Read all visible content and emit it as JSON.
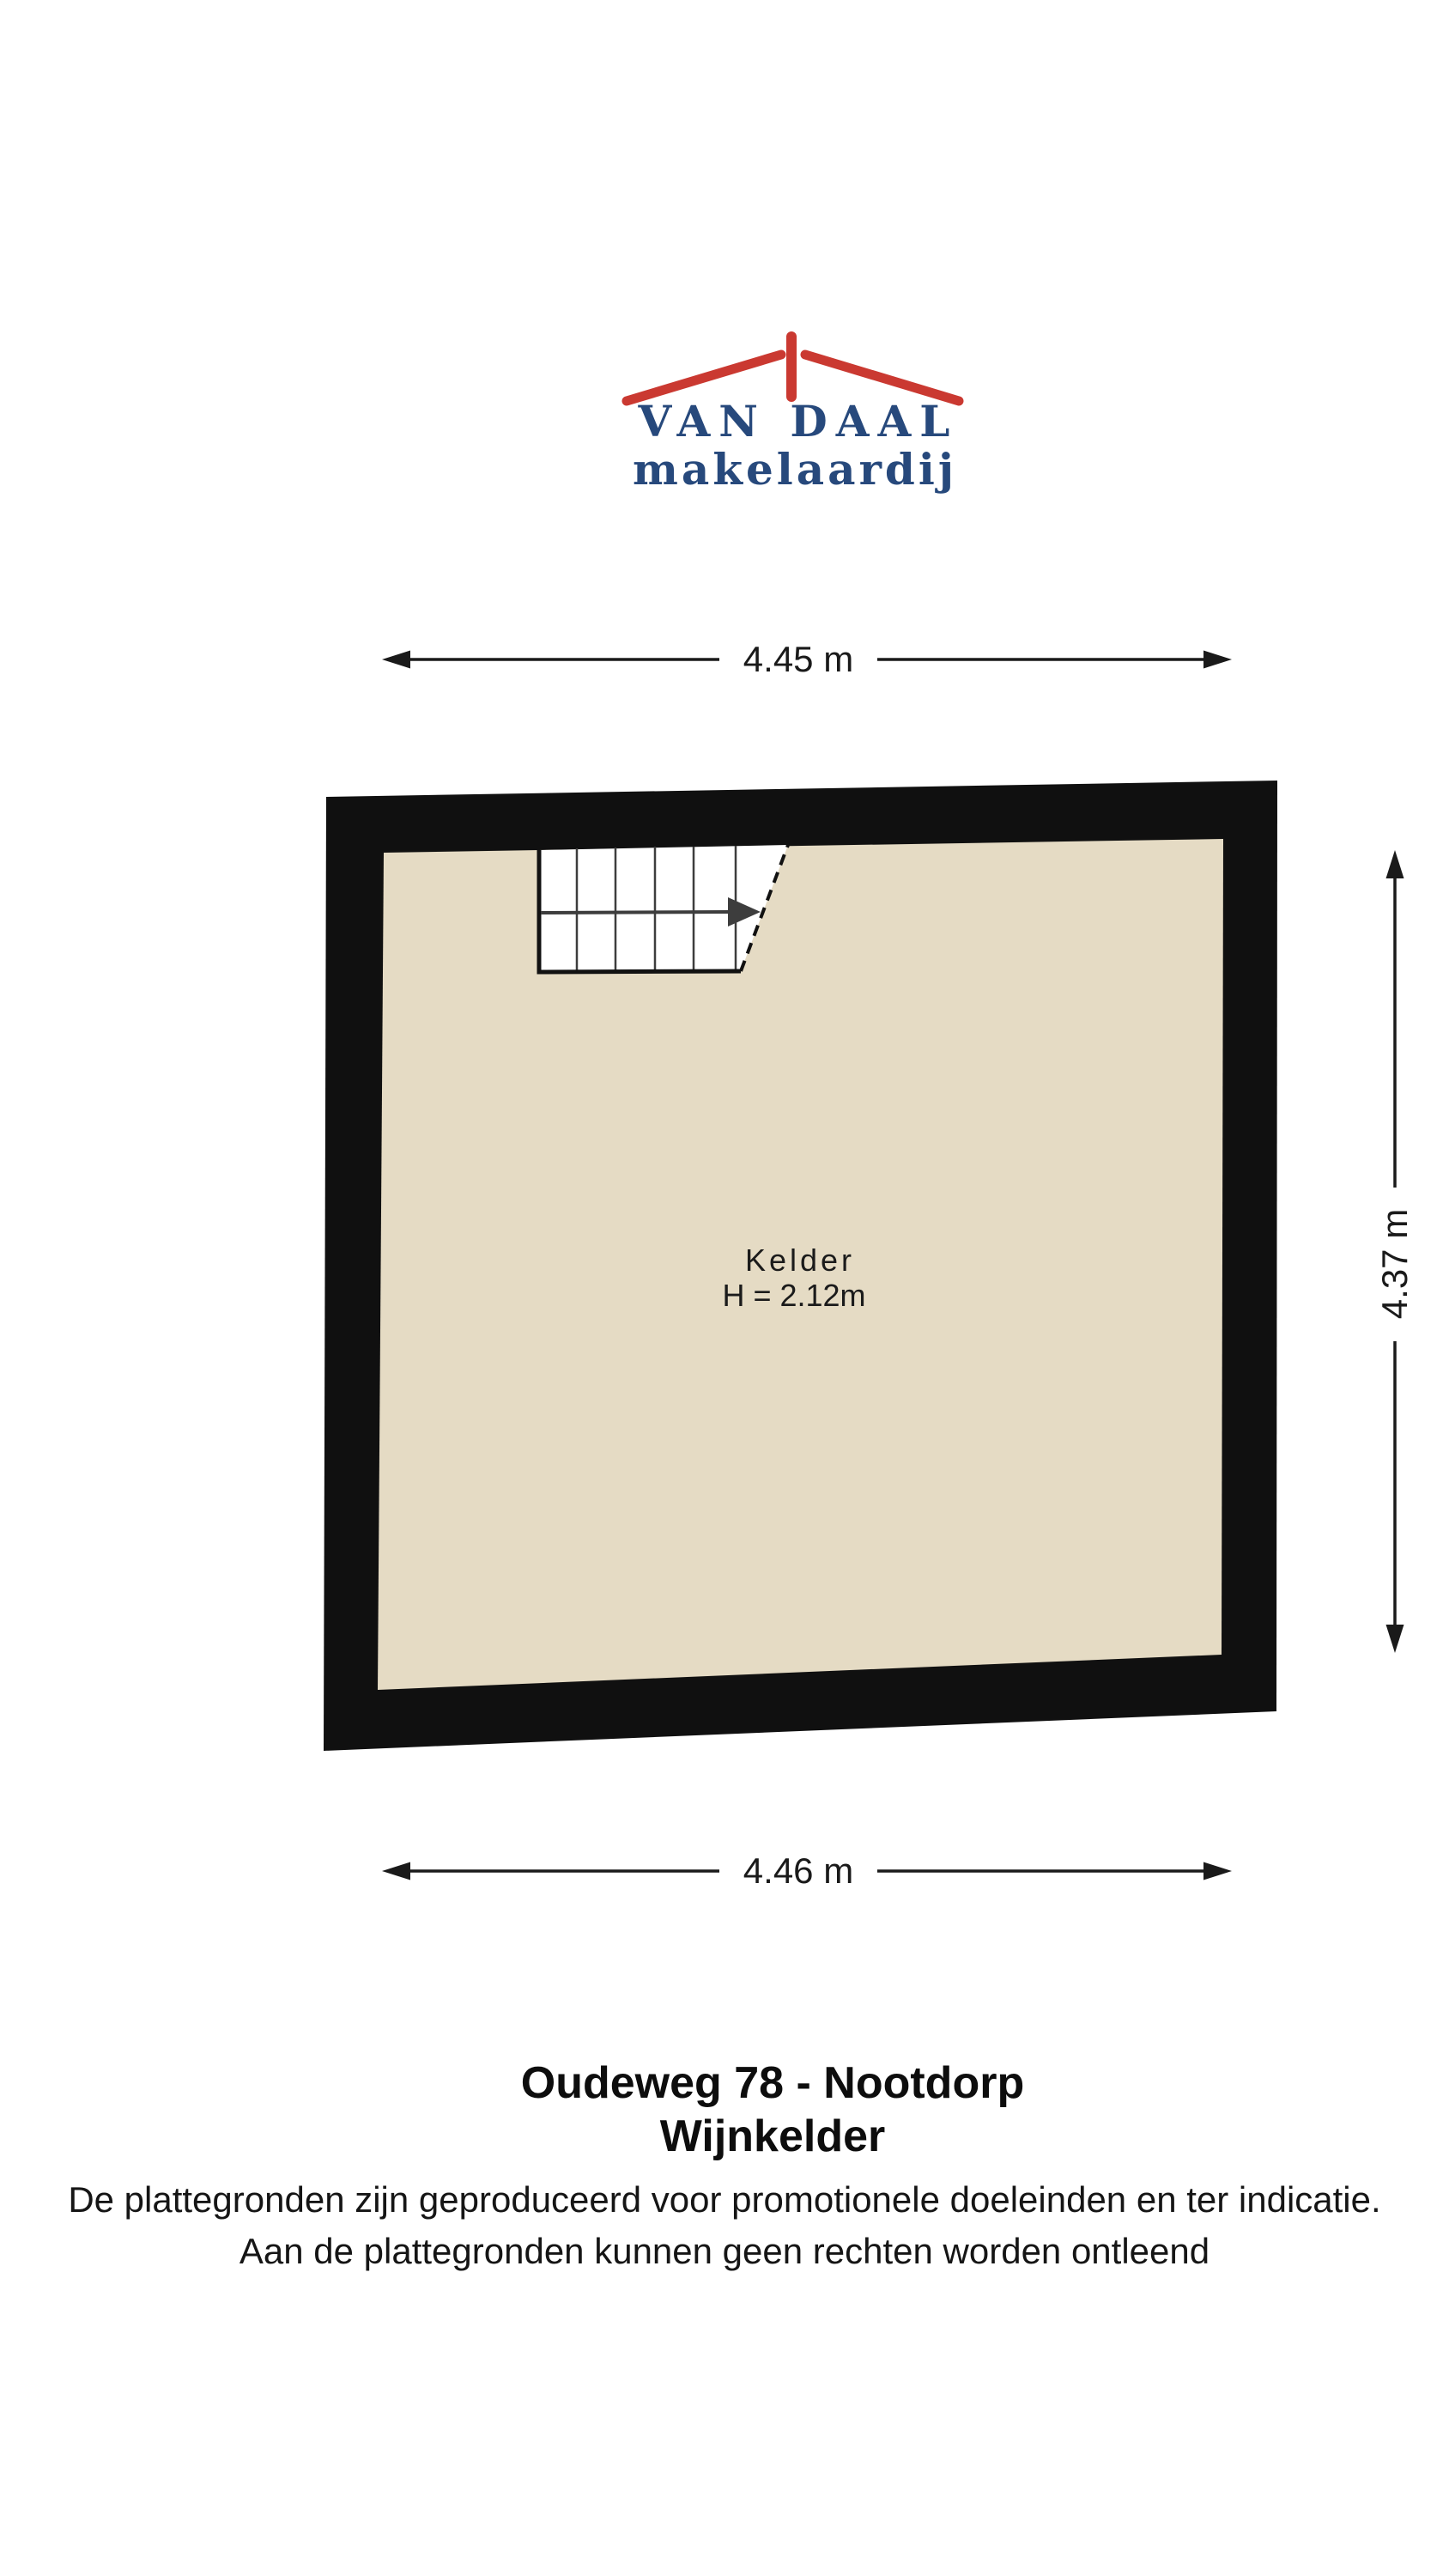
{
  "logo": {
    "brand": "VAN DAAL",
    "tagline": "makelaardij",
    "brand_color": "#27497c",
    "roof_color": "#ca3931"
  },
  "floorplan": {
    "room": {
      "label": "Kelder",
      "ceiling_height": "H = 2.12m"
    },
    "dimensions": {
      "top": "4.45 m",
      "bottom": "4.46 m",
      "right": "4.37 m"
    },
    "colors": {
      "wall": "#101010",
      "floor": "#e5dbc4",
      "stairs": "#ffffff",
      "stair_lines": "#3d3d3d",
      "dimension_lines": "#1a1a1a"
    }
  },
  "footer": {
    "address": "Oudeweg 78 - Nootdorp",
    "floor_name": "Wijnkelder",
    "disclaimer": [
      "De plattegronden zijn geproduceerd voor promotionele doeleinden en ter indicatie.",
      "Aan de plattegronden kunnen geen rechten worden ontleend"
    ]
  }
}
